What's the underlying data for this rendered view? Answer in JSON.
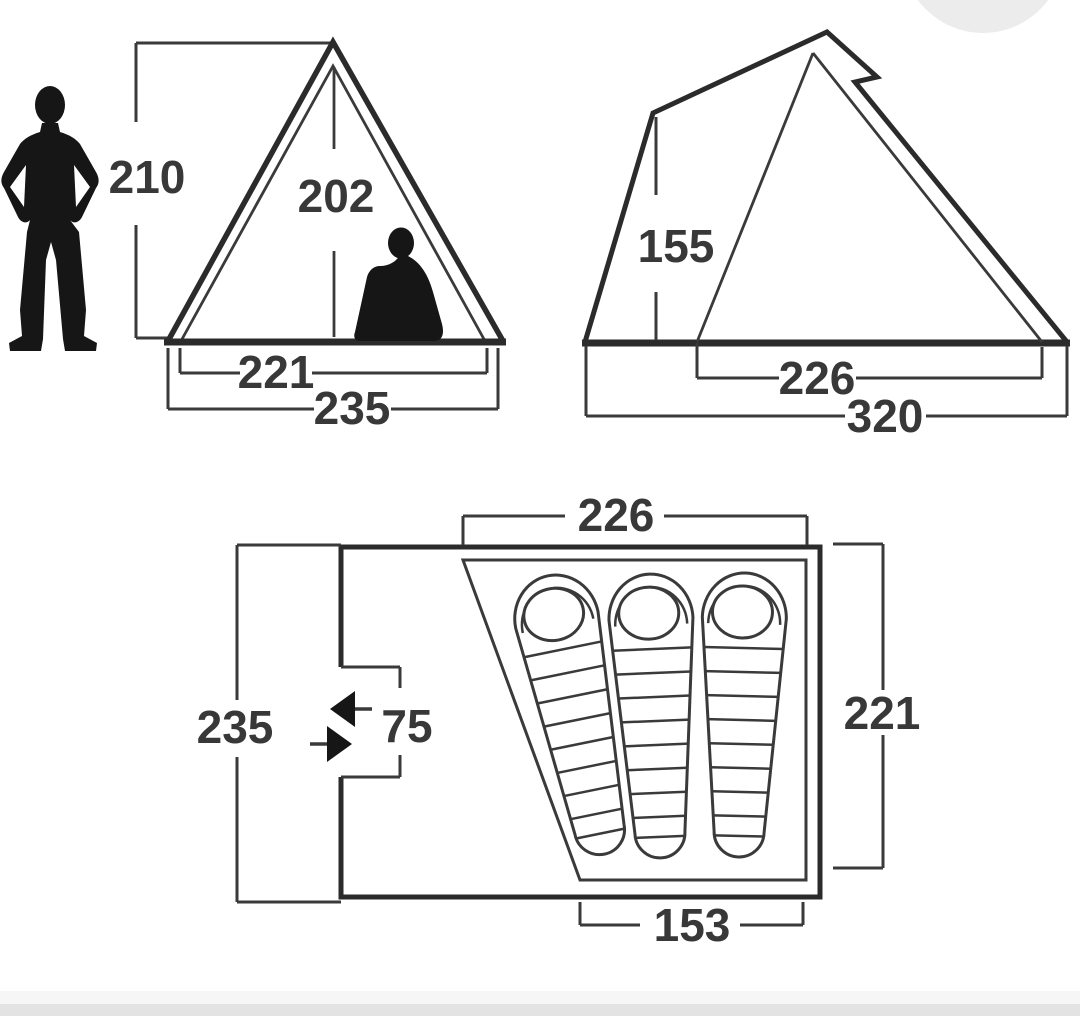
{
  "front_view": {
    "overall_height": "210",
    "inner_height": "202",
    "inner_width": "221",
    "overall_width": "235"
  },
  "side_view": {
    "front_height": "155",
    "inner_length": "226",
    "overall_length": "320"
  },
  "floor_plan": {
    "inner_width_top": "226",
    "overall_depth": "235",
    "door_clearance": "75",
    "inner_depth": "221",
    "inner_width_bottom": "153",
    "sleeping_bag_count": 3
  },
  "colors": {
    "dimension_line": "#3a3a3a",
    "tent_outline": "#2b2b2b",
    "label_text": "#383838",
    "silhouette": "#161616",
    "background": "#ffffff",
    "corner_circle": "#ececec",
    "footer_bar": "#e3e3e3",
    "footer_bar_light": "#f6f6f6"
  }
}
